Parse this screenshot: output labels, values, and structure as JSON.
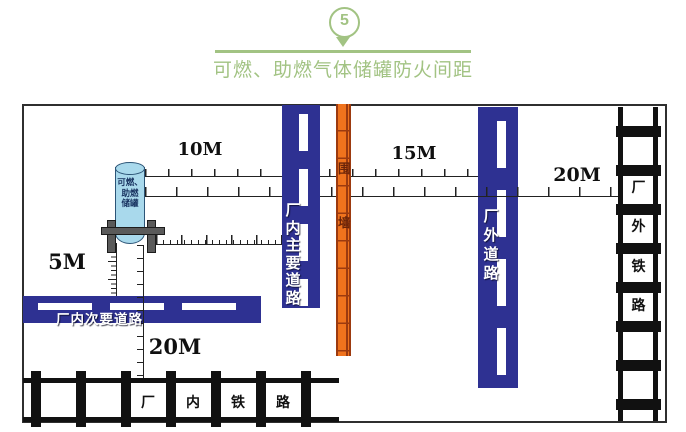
{
  "header": {
    "badge_number": "5",
    "title": "可燃、助燃气体储罐防火间距"
  },
  "distances": {
    "tank_to_main_road": "10M",
    "wall_to_external_road": "15M",
    "external_road_to_external_railway": "20M",
    "tank_to_secondary_road": "5M",
    "tank_to_internal_railway": "20M"
  },
  "tank": {
    "label_lines": [
      "可燃、",
      "助燃",
      "储罐"
    ]
  },
  "wall": {
    "chars": [
      "围",
      "墙"
    ]
  },
  "roads": {
    "internal_main": {
      "chars": [
        "厂",
        "内",
        "主",
        "要",
        "道",
        "路"
      ]
    },
    "internal_secondary": {
      "label": "厂内次要道路"
    },
    "external": {
      "chars": [
        "厂",
        "外",
        "道",
        "路"
      ]
    }
  },
  "railways": {
    "internal": {
      "chars": [
        "厂",
        "内",
        "铁",
        "路"
      ]
    },
    "external": {
      "chars": [
        "厂",
        "外",
        "铁",
        "路"
      ]
    }
  },
  "colors": {
    "accent_green": "#a2c383",
    "road_blue": "#2e3192",
    "wall_orange": "#f0731d",
    "wall_accent": "#9c3a0f",
    "wall_text": "#6b2408",
    "rail_black": "#111111",
    "tank_fill": "#a9d9ec",
    "tank_stroke": "#2c5577",
    "stand_gray": "#5a5a5a"
  }
}
